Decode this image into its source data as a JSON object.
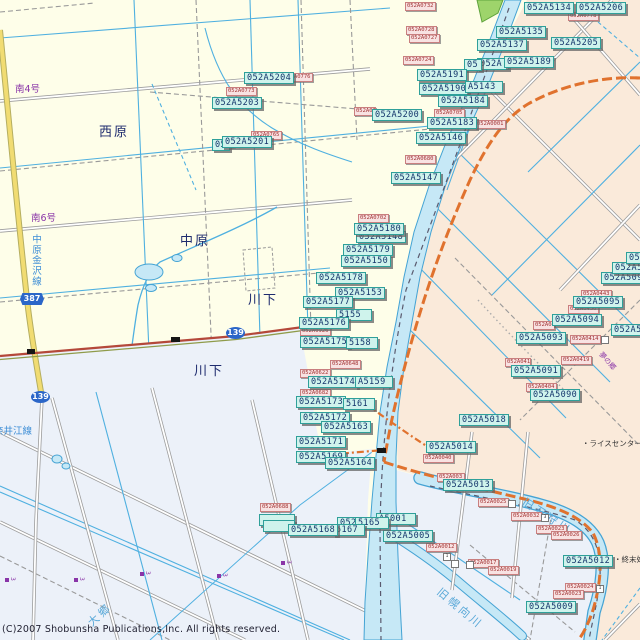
{
  "colors": {
    "land": "#FEFEE9",
    "east_land": "#FAEADA",
    "south_land": "#ECF1F9",
    "water_fill": "#C6E8F6",
    "water_edge": "#44A3D4",
    "canal": "#4FB0E0",
    "chip_bg": "#CFF3EC",
    "chip_border": "#2FA09A",
    "chip_text": "#14356B",
    "red_bg": "#F8E2E2",
    "red_border": "#C97F7F",
    "red_text": "#A23434",
    "shield": "#2B66C8",
    "orange_road": "#E0722E",
    "yellow_road": "#F1DC72",
    "red_road": "#B4483A",
    "green_area": "#9ED46B",
    "place_text": "#1E2B6E",
    "purple_text": "#8A35A8",
    "blue_text": "#3E8ED6",
    "road_gray": "#9C9C9C"
  },
  "texts": {
    "nishihara": "西原",
    "nakahara": "中原",
    "kawashita": "川下",
    "minami4": "南4号",
    "minami6": "南6号",
    "nakahara_kanazawa_line": "中原金沢線",
    "naie_line": "奈井江線",
    "kyu_ishikari_river": "旧石狩川",
    "kyu_horomui_river": "旧幌向川",
    "daigo": "大郷",
    "rice_center": "・ライスセンター",
    "sewage_plant": "・終末処",
    "yume": "夢の郷",
    "copyright": "(C)2007 Shobunsha Publications,Inc. All rights reserved."
  },
  "shields": [
    {
      "label": "387"
    },
    {
      "label": "139"
    },
    {
      "label": "139"
    }
  ],
  "parcel_labels": [
    {
      "t": "052A5134",
      "x": 524,
      "y": 2
    },
    {
      "t": "052A5206",
      "x": 576,
      "y": 2
    },
    {
      "t": "052A5135",
      "x": 496,
      "y": 26
    },
    {
      "t": "052A5137",
      "x": 477,
      "y": 39
    },
    {
      "t": "052A5205",
      "x": 551,
      "y": 37
    },
    {
      "t": "052A5189",
      "x": 504,
      "y": 56
    },
    {
      "t": "052A5191",
      "x": 417,
      "y": 69
    },
    {
      "t": "052A5190",
      "x": 419,
      "y": 83
    },
    {
      "t": "A5143",
      "x": 465,
      "y": 81,
      "w": 32
    },
    {
      "t": "052A5184",
      "x": 438,
      "y": 95
    },
    {
      "t": "052A5200",
      "x": 372,
      "y": 109
    },
    {
      "t": "052A5183",
      "x": 427,
      "y": 117
    },
    {
      "t": "052A5146",
      "x": 416,
      "y": 132
    },
    {
      "t": "052A5147",
      "x": 391,
      "y": 172
    },
    {
      "t": "052A5204",
      "x": 244,
      "y": 72
    },
    {
      "t": "052A5203",
      "x": 212,
      "y": 97
    },
    {
      "t": "052A5201",
      "x": 222,
      "y": 136
    },
    {
      "t": "052A5180",
      "x": 354,
      "y": 223
    },
    {
      "t": "052A5179",
      "x": 343,
      "y": 244
    },
    {
      "t": "052A5150",
      "x": 341,
      "y": 255
    },
    {
      "t": "052A5178",
      "x": 316,
      "y": 272
    },
    {
      "t": "052A5153",
      "x": 335,
      "y": 287
    },
    {
      "t": "052A5177",
      "x": 303,
      "y": 296
    },
    {
      "t": "5155",
      "x": 336,
      "y": 309,
      "w": 30
    },
    {
      "t": "052A5176",
      "x": 299,
      "y": 317
    },
    {
      "t": "052A5175",
      "x": 300,
      "y": 336
    },
    {
      "t": "5158",
      "x": 346,
      "y": 337,
      "w": 26
    },
    {
      "t": "052A5174",
      "x": 308,
      "y": 376
    },
    {
      "t": "A5159",
      "x": 355,
      "y": 376,
      "w": 32
    },
    {
      "t": "052A5173",
      "x": 296,
      "y": 396
    },
    {
      "t": "5161",
      "x": 343,
      "y": 398,
      "w": 26
    },
    {
      "t": "052A5172",
      "x": 300,
      "y": 412
    },
    {
      "t": "052A5163",
      "x": 321,
      "y": 421
    },
    {
      "t": "052A5171",
      "x": 296,
      "y": 436
    },
    {
      "t": "052A5169",
      "x": 296,
      "y": 451
    },
    {
      "t": "052A5164",
      "x": 325,
      "y": 457
    },
    {
      "t": "052A5018",
      "x": 459,
      "y": 414
    },
    {
      "t": "052A5014",
      "x": 426,
      "y": 441
    },
    {
      "t": "052A5013",
      "x": 443,
      "y": 479
    },
    {
      "t": "052A5012",
      "x": 563,
      "y": 555
    },
    {
      "t": "052A5009",
      "x": 526,
      "y": 601
    },
    {
      "t": "052A5005",
      "x": 383,
      "y": 530
    },
    {
      "t": "A5001",
      "x": 376,
      "y": 513,
      "w": 34
    },
    {
      "t": "5165",
      "x": 355,
      "y": 517,
      "w": 28
    },
    {
      "t": "5167",
      "x": 333,
      "y": 524,
      "w": 26
    },
    {
      "t": "052A5168",
      "x": 288,
      "y": 524
    },
    {
      "t": "052A5095",
      "x": 573,
      "y": 296
    },
    {
      "t": "052A5094",
      "x": 552,
      "y": 314
    },
    {
      "t": "052A5093",
      "x": 516,
      "y": 332
    },
    {
      "t": "052A5091",
      "x": 511,
      "y": 365
    },
    {
      "t": "052A5090",
      "x": 530,
      "y": 389
    },
    {
      "t": "052A509",
      "x": 601,
      "y": 272,
      "w": 42
    },
    {
      "t": "052A5",
      "x": 612,
      "y": 262,
      "w": 30
    },
    {
      "t": "05",
      "x": 626,
      "y": 252,
      "w": 16
    },
    {
      "t": "052A50",
      "x": 611,
      "y": 324,
      "w": 32
    }
  ],
  "label_fragments": [
    {
      "t": "052A5148",
      "x": 356,
      "y": 231
    },
    {
      "t": "052A",
      "x": 477,
      "y": 58,
      "w": 26
    },
    {
      "t": "05",
      "x": 464,
      "y": 59,
      "w": 12
    },
    {
      "t": "05",
      "x": 212,
      "y": 139,
      "w": 12
    },
    {
      "t": "052",
      "x": 337,
      "y": 517,
      "w": 14
    },
    {
      "t": "",
      "x": 259,
      "y": 514,
      "w": 30
    },
    {
      "t": "",
      "x": 263,
      "y": 520,
      "w": 26
    }
  ],
  "point_labels": [
    {
      "t": "052A0732",
      "x": 405,
      "y": 2
    },
    {
      "t": "052A0728",
      "x": 406,
      "y": 26
    },
    {
      "t": "052A0727",
      "x": 409,
      "y": 34
    },
    {
      "t": "052A0724",
      "x": 403,
      "y": 56
    },
    {
      "t": "052A0778",
      "x": 568,
      "y": 12
    },
    {
      "t": "052A0776",
      "x": 282,
      "y": 73
    },
    {
      "t": "052A0773",
      "x": 226,
      "y": 87
    },
    {
      "t": "052A0765",
      "x": 251,
      "y": 131
    },
    {
      "t": "052A07",
      "x": 354,
      "y": 107,
      "w": 18
    },
    {
      "t": "052A0705",
      "x": 434,
      "y": 109
    },
    {
      "t": "052A0001",
      "x": 475,
      "y": 120
    },
    {
      "t": "052A0680",
      "x": 405,
      "y": 155
    },
    {
      "t": "052A0702",
      "x": 358,
      "y": 214
    },
    {
      "t": "052A0926",
      "x": 300,
      "y": 327
    },
    {
      "t": "052A0648",
      "x": 330,
      "y": 360
    },
    {
      "t": "052A0622",
      "x": 300,
      "y": 369
    },
    {
      "t": "052A0682",
      "x": 300,
      "y": 389
    },
    {
      "t": "052A0688",
      "x": 260,
      "y": 503
    },
    {
      "t": "052A0040",
      "x": 423,
      "y": 454
    },
    {
      "t": "052A003",
      "x": 437,
      "y": 473,
      "w": 24
    },
    {
      "t": "052A0025",
      "x": 478,
      "y": 498
    },
    {
      "t": "052A0032",
      "x": 511,
      "y": 512
    },
    {
      "t": "052A0023",
      "x": 536,
      "y": 525
    },
    {
      "t": "052A0026",
      "x": 551,
      "y": 531
    },
    {
      "t": "052A0024",
      "x": 565,
      "y": 583
    },
    {
      "t": "052A0023",
      "x": 553,
      "y": 590
    },
    {
      "t": "052A0012",
      "x": 426,
      "y": 543
    },
    {
      "t": "052A0017",
      "x": 468,
      "y": 559
    },
    {
      "t": "052A0019",
      "x": 488,
      "y": 566
    },
    {
      "t": "052A0443",
      "x": 581,
      "y": 290
    },
    {
      "t": "052A0450",
      "x": 568,
      "y": 305
    },
    {
      "t": "052A04",
      "x": 533,
      "y": 321,
      "w": 18
    },
    {
      "t": "052A0414",
      "x": 570,
      "y": 335
    },
    {
      "t": "052A0419",
      "x": 561,
      "y": 356
    },
    {
      "t": "052A041",
      "x": 505,
      "y": 358,
      "w": 22
    },
    {
      "t": "052A0404",
      "x": 526,
      "y": 383
    }
  ],
  "purple_markers": [
    {
      "t": "3",
      "x": 5,
      "y": 577
    },
    {
      "t": "3",
      "x": 74,
      "y": 577
    },
    {
      "t": "3",
      "x": 140,
      "y": 571
    },
    {
      "t": "3",
      "x": 217,
      "y": 573
    },
    {
      "t": "3",
      "x": 281,
      "y": 560
    }
  ],
  "number_boxes": [
    {
      "t": "",
      "x": 508,
      "y": 500
    },
    {
      "t": "3",
      "x": 541,
      "y": 514
    },
    {
      "t": "1",
      "x": 443,
      "y": 553
    },
    {
      "t": "",
      "x": 451,
      "y": 560
    },
    {
      "t": "",
      "x": 466,
      "y": 561
    },
    {
      "t": "1",
      "x": 596,
      "y": 585
    },
    {
      "t": "",
      "x": 601,
      "y": 336
    }
  ]
}
